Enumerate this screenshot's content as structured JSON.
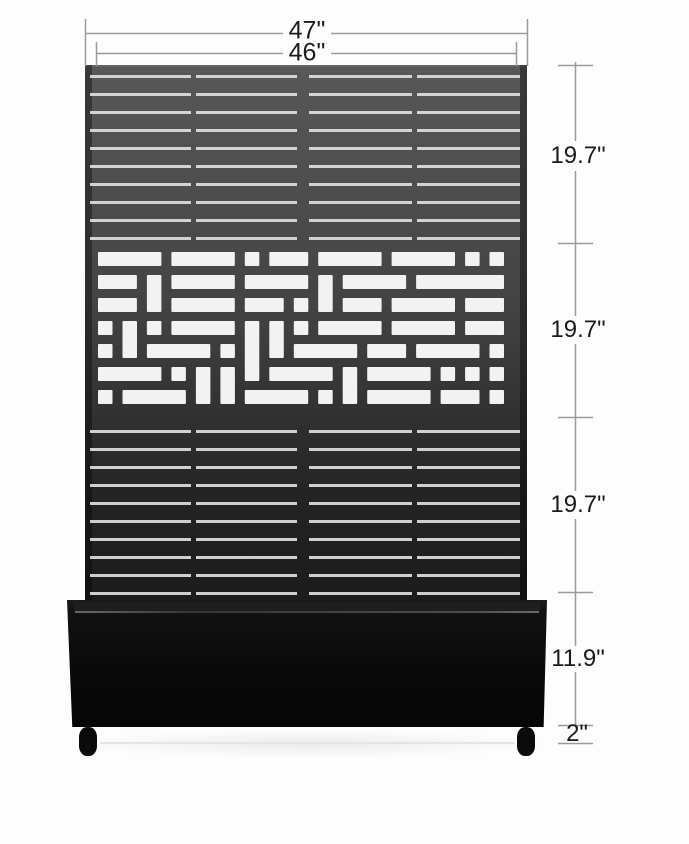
{
  "diagram": {
    "subject": "privacy-screen-with-planter-box",
    "width_dims": {
      "outer": "47\"",
      "inner": "46\""
    },
    "height_dims": {
      "top_slat_section": "19.7\"",
      "lattice_section": "19.7\"",
      "bottom_slat_section": "19.7\"",
      "planter_box": "11.9\"",
      "caster_clearance": "2\""
    }
  },
  "colors": {
    "panel_top": "#585858",
    "panel_bottom": "#1c1c1c",
    "planter": "#0b0b0b",
    "slat_gap_line": "#dedede",
    "lattice_cutout": "#f2f2f2",
    "dimension_line": "#9b9b9b",
    "label_text": "#1b1b1b",
    "background": "#fdfdfd"
  }
}
